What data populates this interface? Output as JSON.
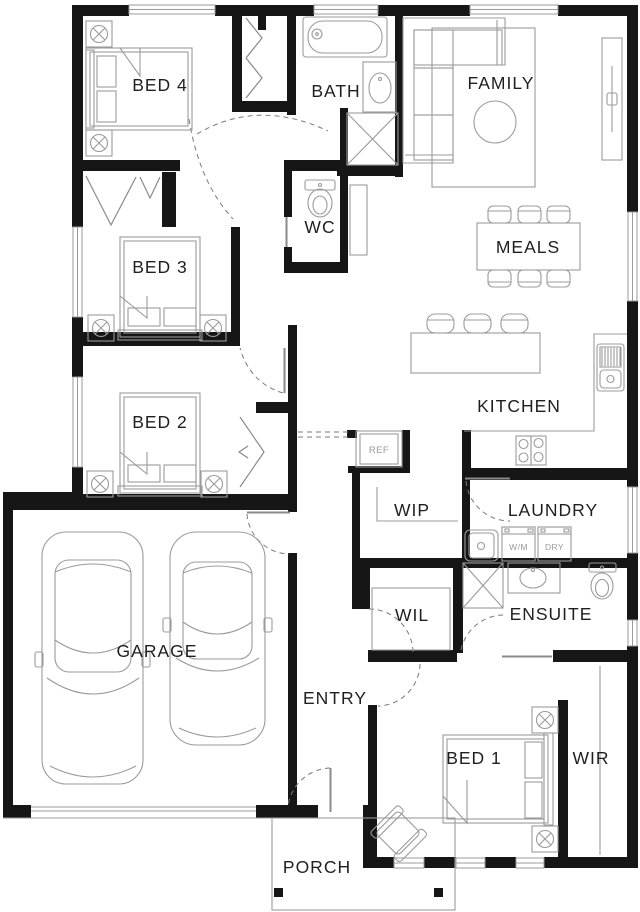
{
  "rooms": {
    "bed4": "BED 4",
    "bath": "BATH",
    "family": "FAMILY",
    "wc": "WC",
    "meals": "MEALS",
    "bed3": "BED 3",
    "kitchen": "KITCHEN",
    "bed2": "BED 2",
    "wip": "WIP",
    "laundry": "LAUNDRY",
    "wil": "WIL",
    "ensuite": "ENSUITE",
    "garage": "GARAGE",
    "entry": "ENTRY",
    "bed1": "BED 1",
    "wir": "WIR",
    "porch": "PORCH"
  },
  "appliances": {
    "fridge": "REF",
    "washing_machine": "W/M",
    "dryer": "DRY"
  },
  "colors": {
    "wall": "#161616",
    "furniture_line": "#9b9b9b",
    "door_swing": "#7a7a7a",
    "text": "#1f1f1f",
    "background": "#ffffff"
  }
}
